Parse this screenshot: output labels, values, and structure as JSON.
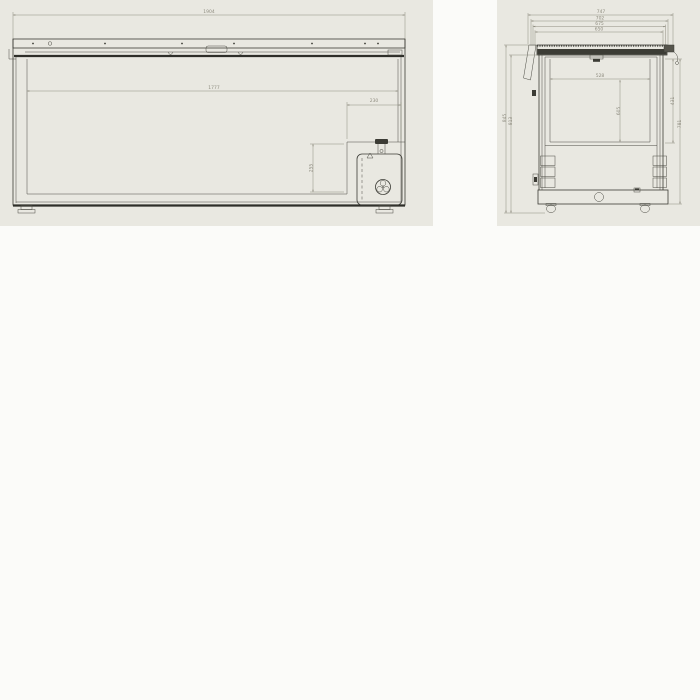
{
  "page": {
    "background": "#fbfbf9",
    "panel_background": "#e9e8e1",
    "line_color": "#3b3b35",
    "dim_color": "#8f8d80"
  },
  "front_view": {
    "dims": {
      "overall_width": "1904",
      "inner_width": "1777",
      "step_width": "230",
      "step_height": "255"
    }
  },
  "side_view": {
    "dims": {
      "depth_overall": "747",
      "depth_2": "702",
      "depth_3": "675",
      "depth_4": "650",
      "height_overall": "845",
      "height_body": "813",
      "inner_width": "528",
      "inner_depth": "605",
      "right_upper": "431",
      "right_lower": "781"
    }
  }
}
